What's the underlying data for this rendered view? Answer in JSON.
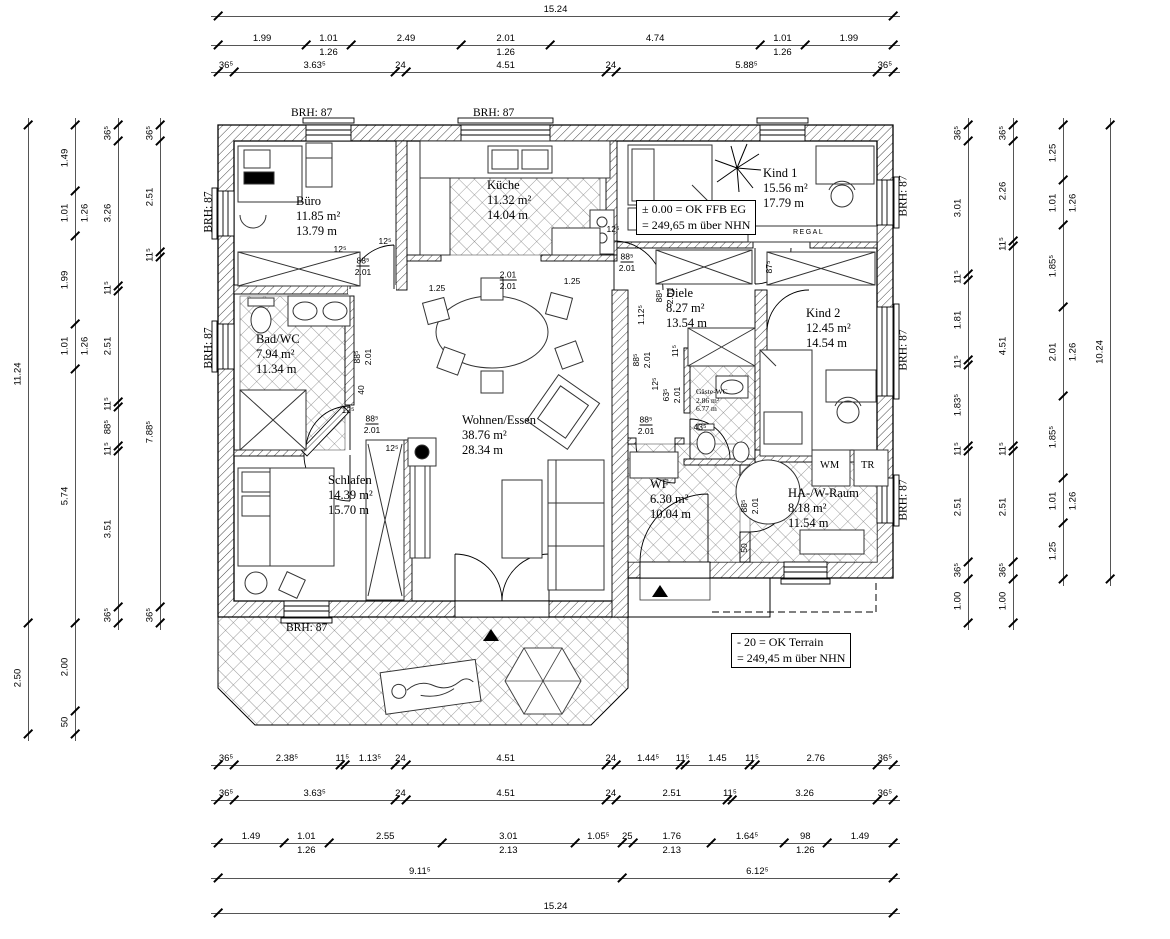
{
  "drawing": {
    "type": "floor-plan",
    "scale_px_per_m": 44.29
  },
  "rooms": [
    {
      "name": "Büro",
      "area": "11.85 m²",
      "perimeter": "13.79 m"
    },
    {
      "name": "Küche",
      "area": "11.32 m²",
      "perimeter": "14.04 m"
    },
    {
      "name": "Kind 1",
      "area": "15.56 m²",
      "perimeter": "17.79 m"
    },
    {
      "name": "Bad/WC",
      "area": "7.94 m²",
      "perimeter": "11.34 m"
    },
    {
      "name": "Diele",
      "area": "8.27 m²",
      "perimeter": "13.54 m"
    },
    {
      "name": "Kind 2",
      "area": "12.45 m²",
      "perimeter": "14.54 m"
    },
    {
      "name": "Gäste-WC",
      "area": "2.86 m²",
      "perimeter": "6.77 m"
    },
    {
      "name": "Wohnen/Essen",
      "area": "38.76 m²",
      "perimeter": "28.34 m"
    },
    {
      "name": "Schlafen",
      "area": "14.39 m²",
      "perimeter": "15.70 m"
    },
    {
      "name": "WF",
      "area": "6.30 m²",
      "perimeter": "10.04 m"
    },
    {
      "name": "HA-/W-Raum",
      "area": "8.18 m²",
      "perimeter": "11.54 m"
    }
  ],
  "labels": {
    "brh": "BRH: 87",
    "regal": "REGAL",
    "wm": "WM",
    "tr": "TR"
  },
  "notes": {
    "ffb_line1": "± 0.00 = OK FFB EG",
    "ffb_line2": "= 249,65 m über NHN",
    "terrain_line1": "- 20 = OK Terrain",
    "terrain_line2": "= 249,45 m über NHN"
  },
  "dims": {
    "top": [
      [
        {
          "t": "15.24",
          "m": 15.24
        }
      ],
      [
        {
          "t": "1.99",
          "m": 1.99
        },
        {
          "t": "1.01",
          "m": 1.01,
          "s": "1.26"
        },
        {
          "t": "2.49",
          "m": 2.49
        },
        {
          "t": "2.01",
          "m": 2.01,
          "s": "1.26"
        },
        {
          "t": "4.74",
          "m": 4.74
        },
        {
          "t": "1.01",
          "m": 1.01,
          "s": "1.26"
        },
        {
          "t": "1.99",
          "m": 1.99
        }
      ],
      [
        {
          "t": "36⁵",
          "m": 0.365
        },
        {
          "t": "3.63⁵",
          "m": 3.635
        },
        {
          "t": "24",
          "m": 0.24
        },
        {
          "t": "4.51",
          "m": 4.51
        },
        {
          "t": "24",
          "m": 0.24
        },
        {
          "t": "5.88⁵",
          "m": 5.885
        },
        {
          "t": "36⁵",
          "m": 0.365
        }
      ]
    ],
    "bottom": [
      [
        {
          "t": "36⁵",
          "m": 0.365
        },
        {
          "t": "2.38⁵",
          "m": 2.385
        },
        {
          "t": "11⁵",
          "m": 0.115
        },
        {
          "t": "1.13⁵",
          "m": 1.135
        },
        {
          "t": "24",
          "m": 0.24
        },
        {
          "t": "4.51",
          "m": 4.51
        },
        {
          "t": "24",
          "m": 0.24
        },
        {
          "t": "1.44⁵",
          "m": 1.445
        },
        {
          "t": "11⁵",
          "m": 0.115
        },
        {
          "t": "1.45",
          "m": 1.45
        },
        {
          "t": "11⁵",
          "m": 0.115
        },
        {
          "t": "2.76",
          "m": 2.76
        },
        {
          "t": "36⁵",
          "m": 0.365
        }
      ],
      [
        {
          "t": "36⁵",
          "m": 0.365
        },
        {
          "t": "3.63⁵",
          "m": 3.635
        },
        {
          "t": "24",
          "m": 0.24
        },
        {
          "t": "4.51",
          "m": 4.51
        },
        {
          "t": "24",
          "m": 0.24
        },
        {
          "t": "2.51",
          "m": 2.51
        },
        {
          "t": "11⁵",
          "m": 0.115
        },
        {
          "t": "3.26",
          "m": 3.26
        },
        {
          "t": "36⁵",
          "m": 0.365
        }
      ],
      [
        {
          "t": "1.49",
          "m": 1.49
        },
        {
          "t": "1.01",
          "m": 1.01,
          "s": "1.26"
        },
        {
          "t": "2.55",
          "m": 2.55
        },
        {
          "t": "3.01",
          "m": 3.01,
          "s": "2.13"
        },
        {
          "t": "1.05⁵",
          "m": 1.055
        },
        {
          "t": "25",
          "m": 0.25
        },
        {
          "t": "1.76",
          "m": 1.76,
          "s": "2.13"
        },
        {
          "t": "1.64⁵",
          "m": 1.645
        },
        {
          "t": "98",
          "m": 0.98,
          "s": "1.26"
        },
        {
          "t": "1.49",
          "m": 1.49
        }
      ],
      [
        {
          "t": "9.11⁵",
          "m": 9.115
        },
        {
          "t": "6.12⁵",
          "m": 6.125
        }
      ],
      [
        {
          "t": "15.24",
          "m": 15.24
        }
      ]
    ],
    "left": [
      [
        {
          "t": "11.24",
          "m": 11.24
        },
        {
          "t": "2.50",
          "m": 2.5
        }
      ],
      [
        {
          "t": "1.49",
          "m": 1.49
        },
        {
          "t": "1.01",
          "m": 1.01,
          "s": "1.26"
        },
        {
          "t": "1.99",
          "m": 1.99
        },
        {
          "t": "1.01",
          "m": 1.01,
          "s": "1.26"
        },
        {
          "t": "5.74",
          "m": 5.74
        },
        {
          "t": "2.00",
          "m": 2.0
        },
        {
          "t": "50",
          "m": 0.5
        }
      ],
      [
        {
          "t": "36⁵",
          "m": 0.365
        },
        {
          "t": "3.26",
          "m": 3.26
        },
        {
          "t": "11⁵",
          "m": 0.115
        },
        {
          "t": "2.51",
          "m": 2.51
        },
        {
          "t": "11⁵",
          "m": 0.115
        },
        {
          "t": "88⁵",
          "m": 0.885
        },
        {
          "t": "11⁵",
          "m": 0.115
        },
        {
          "t": "3.51",
          "m": 3.51
        },
        {
          "t": "36⁵",
          "m": 0.365
        }
      ],
      [
        {
          "t": "36⁵",
          "m": 0.365
        },
        {
          "t": "2.51",
          "m": 2.51
        },
        {
          "t": "11⁵",
          "m": 0.115
        },
        {
          "t": "7.88⁵",
          "m": 7.885
        },
        {
          "t": "36⁵",
          "m": 0.365
        }
      ]
    ],
    "right": [
      [
        {
          "t": "36⁵",
          "m": 0.365
        },
        {
          "t": "3.01",
          "m": 3.01
        },
        {
          "t": "11⁵",
          "m": 0.115
        },
        {
          "t": "1.81",
          "m": 1.81
        },
        {
          "t": "11⁵",
          "m": 0.115
        },
        {
          "t": "1.83⁵",
          "m": 1.835
        },
        {
          "t": "11⁵",
          "m": 0.115
        },
        {
          "t": "2.51",
          "m": 2.51
        },
        {
          "t": "36⁵",
          "m": 0.365
        },
        {
          "t": "1.00",
          "m": 1.0
        }
      ],
      [
        {
          "t": "36⁵",
          "m": 0.365
        },
        {
          "t": "2.26",
          "m": 2.26
        },
        {
          "t": "11⁵",
          "m": 0.115
        },
        {
          "t": "4.51",
          "m": 4.51
        },
        {
          "t": "11⁵",
          "m": 0.115
        },
        {
          "t": "2.51",
          "m": 2.51
        },
        {
          "t": "36⁵",
          "m": 0.365
        },
        {
          "t": "1.00",
          "m": 1.0
        }
      ],
      [
        {
          "t": "1.25",
          "m": 1.25
        },
        {
          "t": "1.01",
          "m": 1.01,
          "s": "1.26"
        },
        {
          "t": "1.85⁵",
          "m": 1.855
        },
        {
          "t": "2.01",
          "m": 2.01,
          "s": "1.26"
        },
        {
          "t": "1.85⁵",
          "m": 1.855
        },
        {
          "t": "1.01",
          "m": 1.01,
          "s": "1.26"
        },
        {
          "t": "1.25",
          "m": 1.25
        }
      ],
      [
        {
          "t": "10.24",
          "m": 10.24
        }
      ]
    ]
  },
  "inner_dims": [
    {
      "t": "12⁵"
    },
    {
      "t": "88⁵"
    },
    {
      "t": "2.01"
    },
    {
      "t": "12⁵"
    },
    {
      "t": "1.25"
    },
    {
      "t": "2.01"
    },
    {
      "t": "2.01"
    },
    {
      "t": "1.25"
    },
    {
      "t": "12⁵"
    },
    {
      "t": "88⁵"
    },
    {
      "t": "2.01"
    },
    {
      "t": "87⁵"
    },
    {
      "t": "88⁵"
    },
    {
      "t": "2.01"
    },
    {
      "t": "1.12⁵"
    },
    {
      "t": "88⁵"
    },
    {
      "t": "2.01"
    },
    {
      "t": "11⁵"
    },
    {
      "t": "12⁵"
    },
    {
      "t": "63⁵"
    },
    {
      "t": "2.01"
    },
    {
      "t": "88⁵"
    },
    {
      "t": "2.01"
    },
    {
      "t": "43⁵"
    },
    {
      "t": "88⁵"
    },
    {
      "t": "2.01"
    },
    {
      "t": "40"
    },
    {
      "t": "12⁵"
    },
    {
      "t": "88⁵"
    },
    {
      "t": "2.01"
    },
    {
      "t": "12⁵"
    },
    {
      "t": "88⁵"
    },
    {
      "t": "2.01"
    },
    {
      "t": "50"
    }
  ]
}
